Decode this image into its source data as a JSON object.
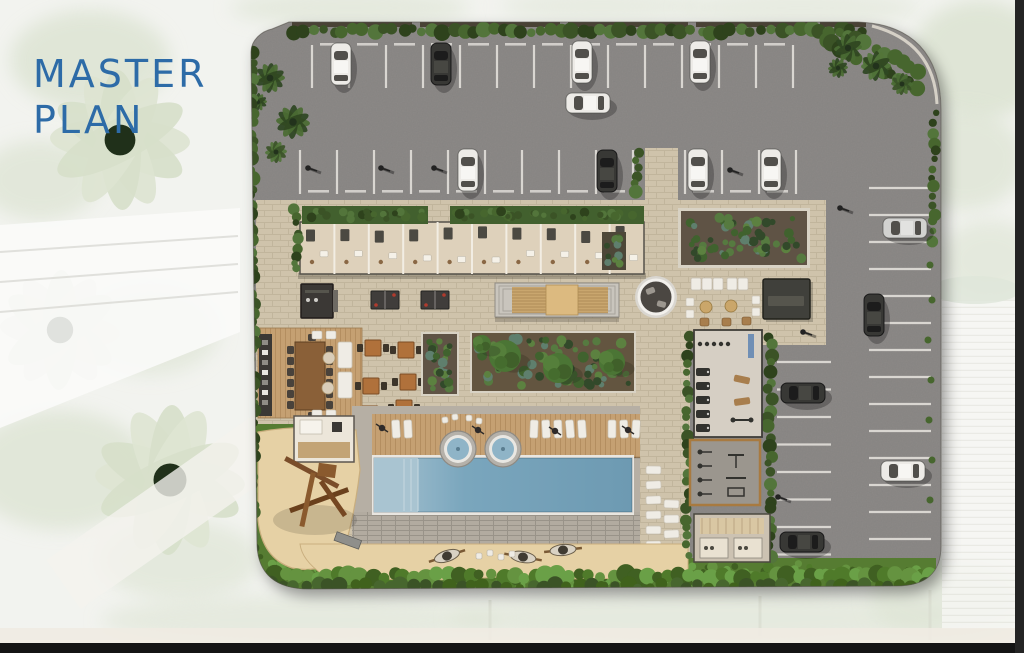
{
  "title": {
    "line1": "MASTER",
    "line2": "PLAN"
  },
  "palette": {
    "title_blue": "#2d6ba7",
    "bg": "#f2f3ef",
    "bg_foliage": "#dce3d2",
    "bg_building": "#fbfbf9",
    "band_light": "#efebe2",
    "frame_bottom": "#141414",
    "frame_right": "#242424",
    "asphalt": "#8d8a88",
    "stall_line": "#d9d6d1",
    "paver": "#cfc3ab",
    "paver_line": "#b3a78d",
    "hedge_dark": "#3a5328",
    "hedge_mid": "#47662f",
    "hedge_deep": "#2d431e",
    "hedge_light": "#52753a",
    "grass": "#567c30",
    "grass_bright": "#649140",
    "grass_deep": "#41621f",
    "sand": "#e6d1a5",
    "sand_edge": "#c9ae7e",
    "deck_wood": "#c5a072",
    "deck_line": "#a67f52",
    "pool_water": "#7aa6bd",
    "pool_light": "#a9c4d1",
    "pool_deep": "#6d9ab2",
    "coping": "#e9e6e0",
    "surround": "#b6afa4",
    "brick_band": "#b2aba0",
    "building_floor": "#ded1bb",
    "roof_green": "#42602e",
    "furniture_dark": "#3b3935",
    "wood_dark": "#8a6138",
    "wood_light": "#c9a66e",
    "table_orange": "#b0713a",
    "white_obj": "#efece5",
    "gym_floor": "#d6cfc4",
    "outdoor_gym_floor": "#9b968e",
    "wood_border": "#a87a3f",
    "soil": "#5e5344",
    "plant_teal": "#5e7f6d",
    "blue_mat": "#6f8fb5",
    "ping_pong_red": "#b03a2e",
    "pouf_tan": "#caa66b",
    "car_white": "#edebe7",
    "car_dark": "#393836",
    "car_silver": "#d2d2d0"
  },
  "plan": {
    "cars": [
      {
        "x": 341,
        "y": 64,
        "o": "v",
        "c": "white"
      },
      {
        "x": 441,
        "y": 64,
        "o": "v",
        "c": "dark"
      },
      {
        "x": 582,
        "y": 62,
        "o": "v",
        "c": "white"
      },
      {
        "x": 700,
        "y": 62,
        "o": "v",
        "c": "white"
      },
      {
        "x": 588,
        "y": 103,
        "o": "h",
        "c": "white"
      },
      {
        "x": 468,
        "y": 170,
        "o": "v",
        "c": "white"
      },
      {
        "x": 607,
        "y": 171,
        "o": "v",
        "c": "dark"
      },
      {
        "x": 698,
        "y": 170,
        "o": "v",
        "c": "white"
      },
      {
        "x": 771,
        "y": 170,
        "o": "v",
        "c": "white"
      },
      {
        "x": 905,
        "y": 228,
        "o": "h",
        "c": "silver"
      },
      {
        "x": 874,
        "y": 315,
        "o": "v",
        "c": "dark"
      },
      {
        "x": 803,
        "y": 393,
        "o": "h",
        "c": "dark"
      },
      {
        "x": 903,
        "y": 471,
        "o": "h",
        "c": "white"
      },
      {
        "x": 802,
        "y": 542,
        "o": "h",
        "c": "dark"
      }
    ],
    "lamps": [
      [
        308,
        168
      ],
      [
        381,
        168
      ],
      [
        434,
        168
      ],
      [
        730,
        170
      ],
      [
        840,
        208
      ],
      [
        803,
        332
      ],
      [
        778,
        497
      ]
    ],
    "umbrellas": [
      [
        382,
        428
      ],
      [
        478,
        430
      ],
      [
        555,
        431
      ],
      [
        628,
        430
      ]
    ],
    "deck_loungers": [
      392,
      404,
      530,
      542,
      554,
      566,
      578,
      608,
      620,
      632
    ],
    "jacuzzis": [
      [
        458,
        449
      ],
      [
        503,
        449
      ]
    ],
    "side_loungers": {
      "col1_x": 646,
      "col1_y0": 466,
      "count1": 6,
      "col2_x": 664,
      "col2_y0": 500,
      "count2": 4,
      "step": 15
    },
    "hammocks": [
      [
        447,
        556,
        -18
      ],
      [
        523,
        557,
        10
      ],
      [
        563,
        550,
        -6
      ]
    ],
    "poufs": [
      [
        476,
        553
      ],
      [
        487,
        550
      ],
      [
        498,
        554
      ],
      [
        509,
        551
      ]
    ],
    "dining_tables": [
      [
        373,
        348
      ],
      [
        406,
        350
      ],
      [
        371,
        386
      ],
      [
        408,
        382
      ],
      [
        370,
        414
      ],
      [
        404,
        408
      ]
    ],
    "trees": [
      [
        505,
        356,
        16
      ],
      [
        558,
        368,
        15
      ],
      [
        612,
        362,
        13
      ],
      [
        482,
        344,
        9
      ]
    ],
    "ping_pong": [
      [
        385,
        300
      ],
      [
        435,
        300
      ]
    ],
    "parking": {
      "row_top": {
        "x0": 312,
        "step": 37,
        "count": 14,
        "y0": 45,
        "y1": 88
      },
      "row_mid_left": {
        "x0": 300,
        "step": 37,
        "count": 10,
        "y0": 150,
        "y1": 194
      },
      "row_mid_right": {
        "x0": 685,
        "step": 37,
        "count": 4,
        "y0": 150,
        "y1": 194
      },
      "col_right": {
        "x0": 869,
        "x1": 931,
        "y0": 188,
        "step": 27,
        "count": 14
      },
      "col_mid": {
        "x0": 777,
        "x1": 831,
        "y0": 362,
        "step": 27.5,
        "count": 8
      }
    }
  }
}
